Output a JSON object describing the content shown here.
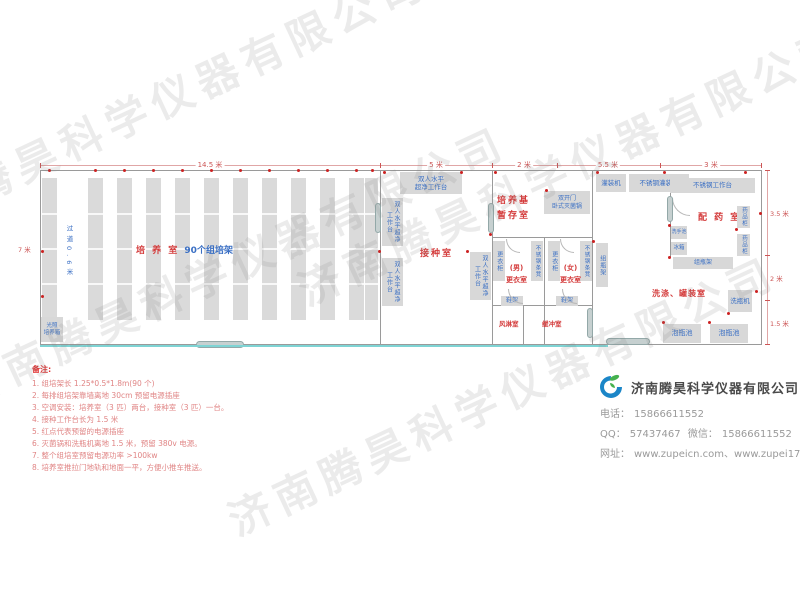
{
  "watermark": {
    "text": "济南腾昊科学仪器有限公司"
  },
  "plan": {
    "dims": {
      "top": [
        "14.5 米",
        "5 米",
        "2 米",
        "5.5 米",
        "3 米"
      ],
      "right": [
        "3.5 米",
        "2 米",
        "1.5 米"
      ],
      "left": "7 米",
      "aisle": "过道0.6米"
    },
    "rooms": {
      "culture_title": "培 养 室",
      "culture_sub": "90个组培架",
      "inoculation": "接种室",
      "medium_line1": "培养基",
      "medium_line2": "暂存室",
      "mens_line1": "(男)",
      "mens_line2": "更衣室",
      "womens_line1": "(女)",
      "womens_line2": "更衣室",
      "air_shower": "风淋室",
      "buffer": "缓冲室",
      "pharmacy": "配 药 室",
      "washing": "洗涤、罐装室"
    },
    "equip": {
      "bench_line1": "双人水平",
      "bench_line2": "超净工作台",
      "bench_full": "双人水平超净工作台",
      "incubator_line1": "光照",
      "incubator_line2": "培养箱",
      "sterilizer_line1": "双开门",
      "sterilizer_line2": "卧式灭菌锅",
      "wardrobe": "更衣柜",
      "steel_bench": "不锈钢条凳",
      "shoe_rack": "鞋架",
      "bottle_rack": "组瓶架",
      "filler": "灌装机",
      "fill_table": "不锈钢灌装台",
      "work_table": "不锈钢工作台",
      "sink": "洗手池",
      "fridge": "冰箱",
      "med_cabinet": "药品柜",
      "bottle_washer": "洗瓶机",
      "soak_pool": "泡瓶池"
    }
  },
  "notes": {
    "title": "备注:",
    "items": [
      "1.  组培架长 1.25*0.5*1.8m(90 个)",
      "2.  每排组培架靠墙离地 30cm 预留电源插座",
      "3.  空调安装：培养室（3 匹）两台，接种室（3 匹）一台。",
      "4.  接种工作台长为 1.5 米",
      "5.  红点代表预留的电源插座",
      "6.  灭菌锅和洗瓶机离地 1.5 米，预留 380v 电源。",
      "7.  整个组培室预留电源功率 >100kw",
      "8.  培养室推拉门地轨和地面一平，方便小推车推送。"
    ]
  },
  "company": {
    "name": "济南腾昊科学仪器有限公司",
    "phone_label": "电话：",
    "phone": "15866611552",
    "qq_label": "QQ：",
    "qq": "57437467",
    "wechat_label": "微信：",
    "wechat": "15866611552",
    "web_label": "网址：",
    "web": "www.zupeicn.com、www.zupei17.com"
  },
  "colors": {
    "room_label_red": "#d43c3c",
    "equipment_blue": "#3a6fc4",
    "box_gray": "#d8d8d8",
    "track_cyan": "#7ed4d4",
    "outlet_red": "#cc2222",
    "brand_blue": "#1b86c8",
    "brand_green": "#45b14e"
  }
}
